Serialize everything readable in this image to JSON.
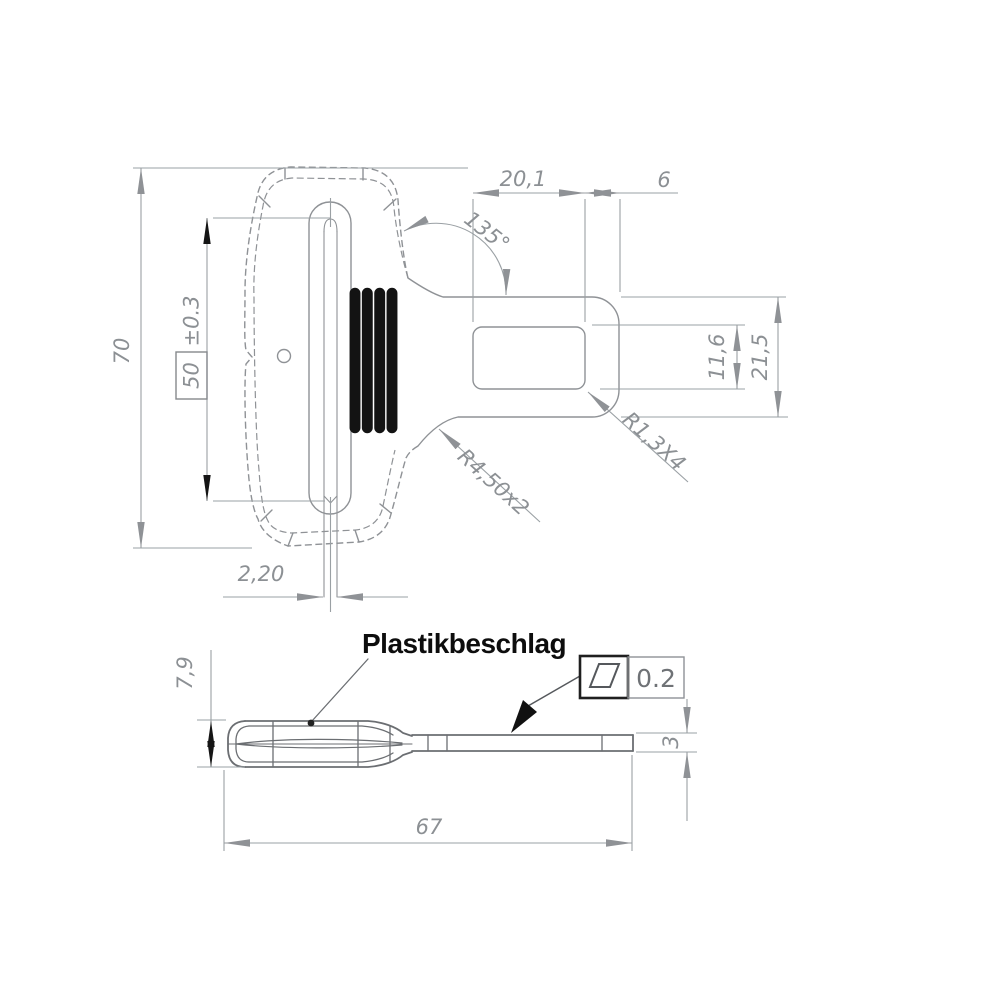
{
  "drawing": {
    "part_name": "Plastikbeschlag",
    "front_view": {
      "overall_height": "70",
      "slit_length": "50",
      "slit_length_tolerance": "±0.3",
      "slit_width": "2,20",
      "tongue_slot_length": "20,1",
      "slot_to_tip_distance": "6",
      "neck_angle": "135°",
      "tongue_slot_width": "11,6",
      "tongue_width": "21,5",
      "tongue_slot_corner_radius": "R1,3X4",
      "neck_fillet_radius": "R4,50x2"
    },
    "side_view": {
      "callout_label": "Plastikbeschlag",
      "grip_thickness": "7,9",
      "plate_thickness": "3",
      "overall_length": "67",
      "flatness_tolerance": "0.2",
      "flatness_symbol": "parallelogram-flatness-icon"
    },
    "colors": {
      "background": "#ffffff",
      "outline_gray": "#8f9296",
      "dimension_gray": "#9aa0a4",
      "text_gray": "#8c9094",
      "side_view_gray": "#6b6e72",
      "accent_black": "#151515"
    }
  }
}
